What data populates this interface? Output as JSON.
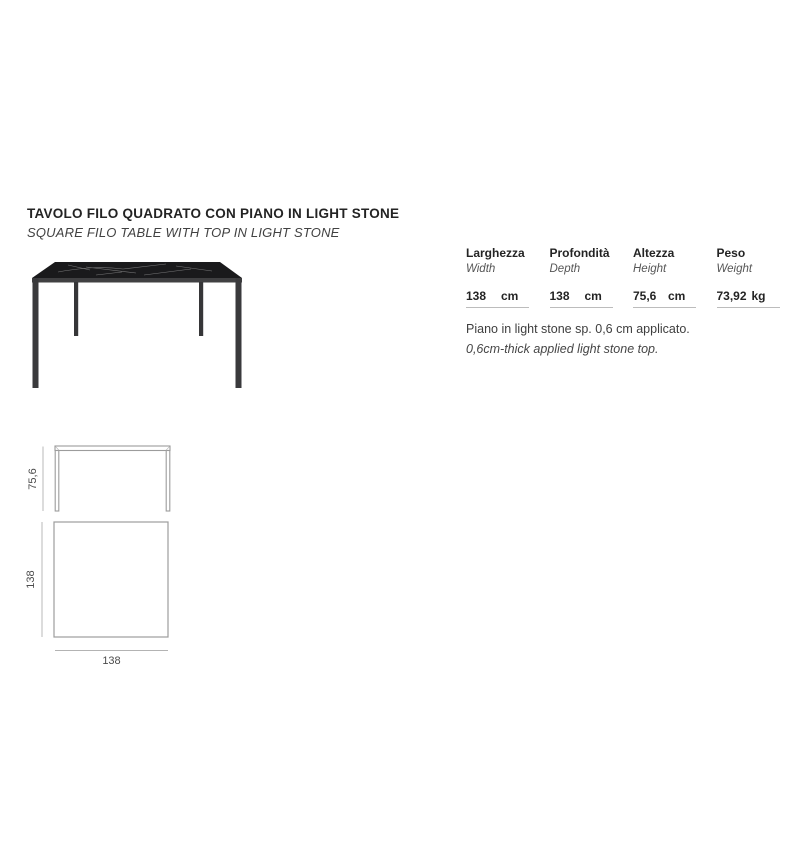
{
  "header": {
    "title_it": "TAVOLO FILO QUADRATO CON PIANO IN LIGHT STONE",
    "title_en": "SQUARE FILO TABLE WITH TOP IN LIGHT STONE"
  },
  "product": {
    "description": "square table with black light-stone marble top and thin dark metal legs"
  },
  "specs": {
    "columns": [
      {
        "label": "Larghezza",
        "label_en": "Width",
        "value": "138",
        "unit": "cm"
      },
      {
        "label": "Profondità",
        "label_en": "Depth",
        "value": "138",
        "unit": "cm"
      },
      {
        "label": "Altezza",
        "label_en": "Height",
        "value": "75,6",
        "unit": "cm"
      },
      {
        "label": "Peso",
        "label_en": "Weight",
        "value": "73,92",
        "unit": "kg"
      }
    ],
    "note_it": "Piano in light stone sp. 0,6 cm applicato.",
    "note_en": "0,6cm-thick applied light stone top."
  },
  "drawings": {
    "front_view_height_label": "75,6",
    "top_view_depth_label": "138",
    "top_view_width_label": "138"
  },
  "colors": {
    "background": "#ffffff",
    "title_text": "#232323",
    "secondary_text": "#565656",
    "marble_top": "#1a1a1c",
    "table_frame": "#3a3a3c",
    "drawing_stroke": "#9c9c9c",
    "dimension_line": "#b3b3b3",
    "underline": "#bcbcbc"
  }
}
